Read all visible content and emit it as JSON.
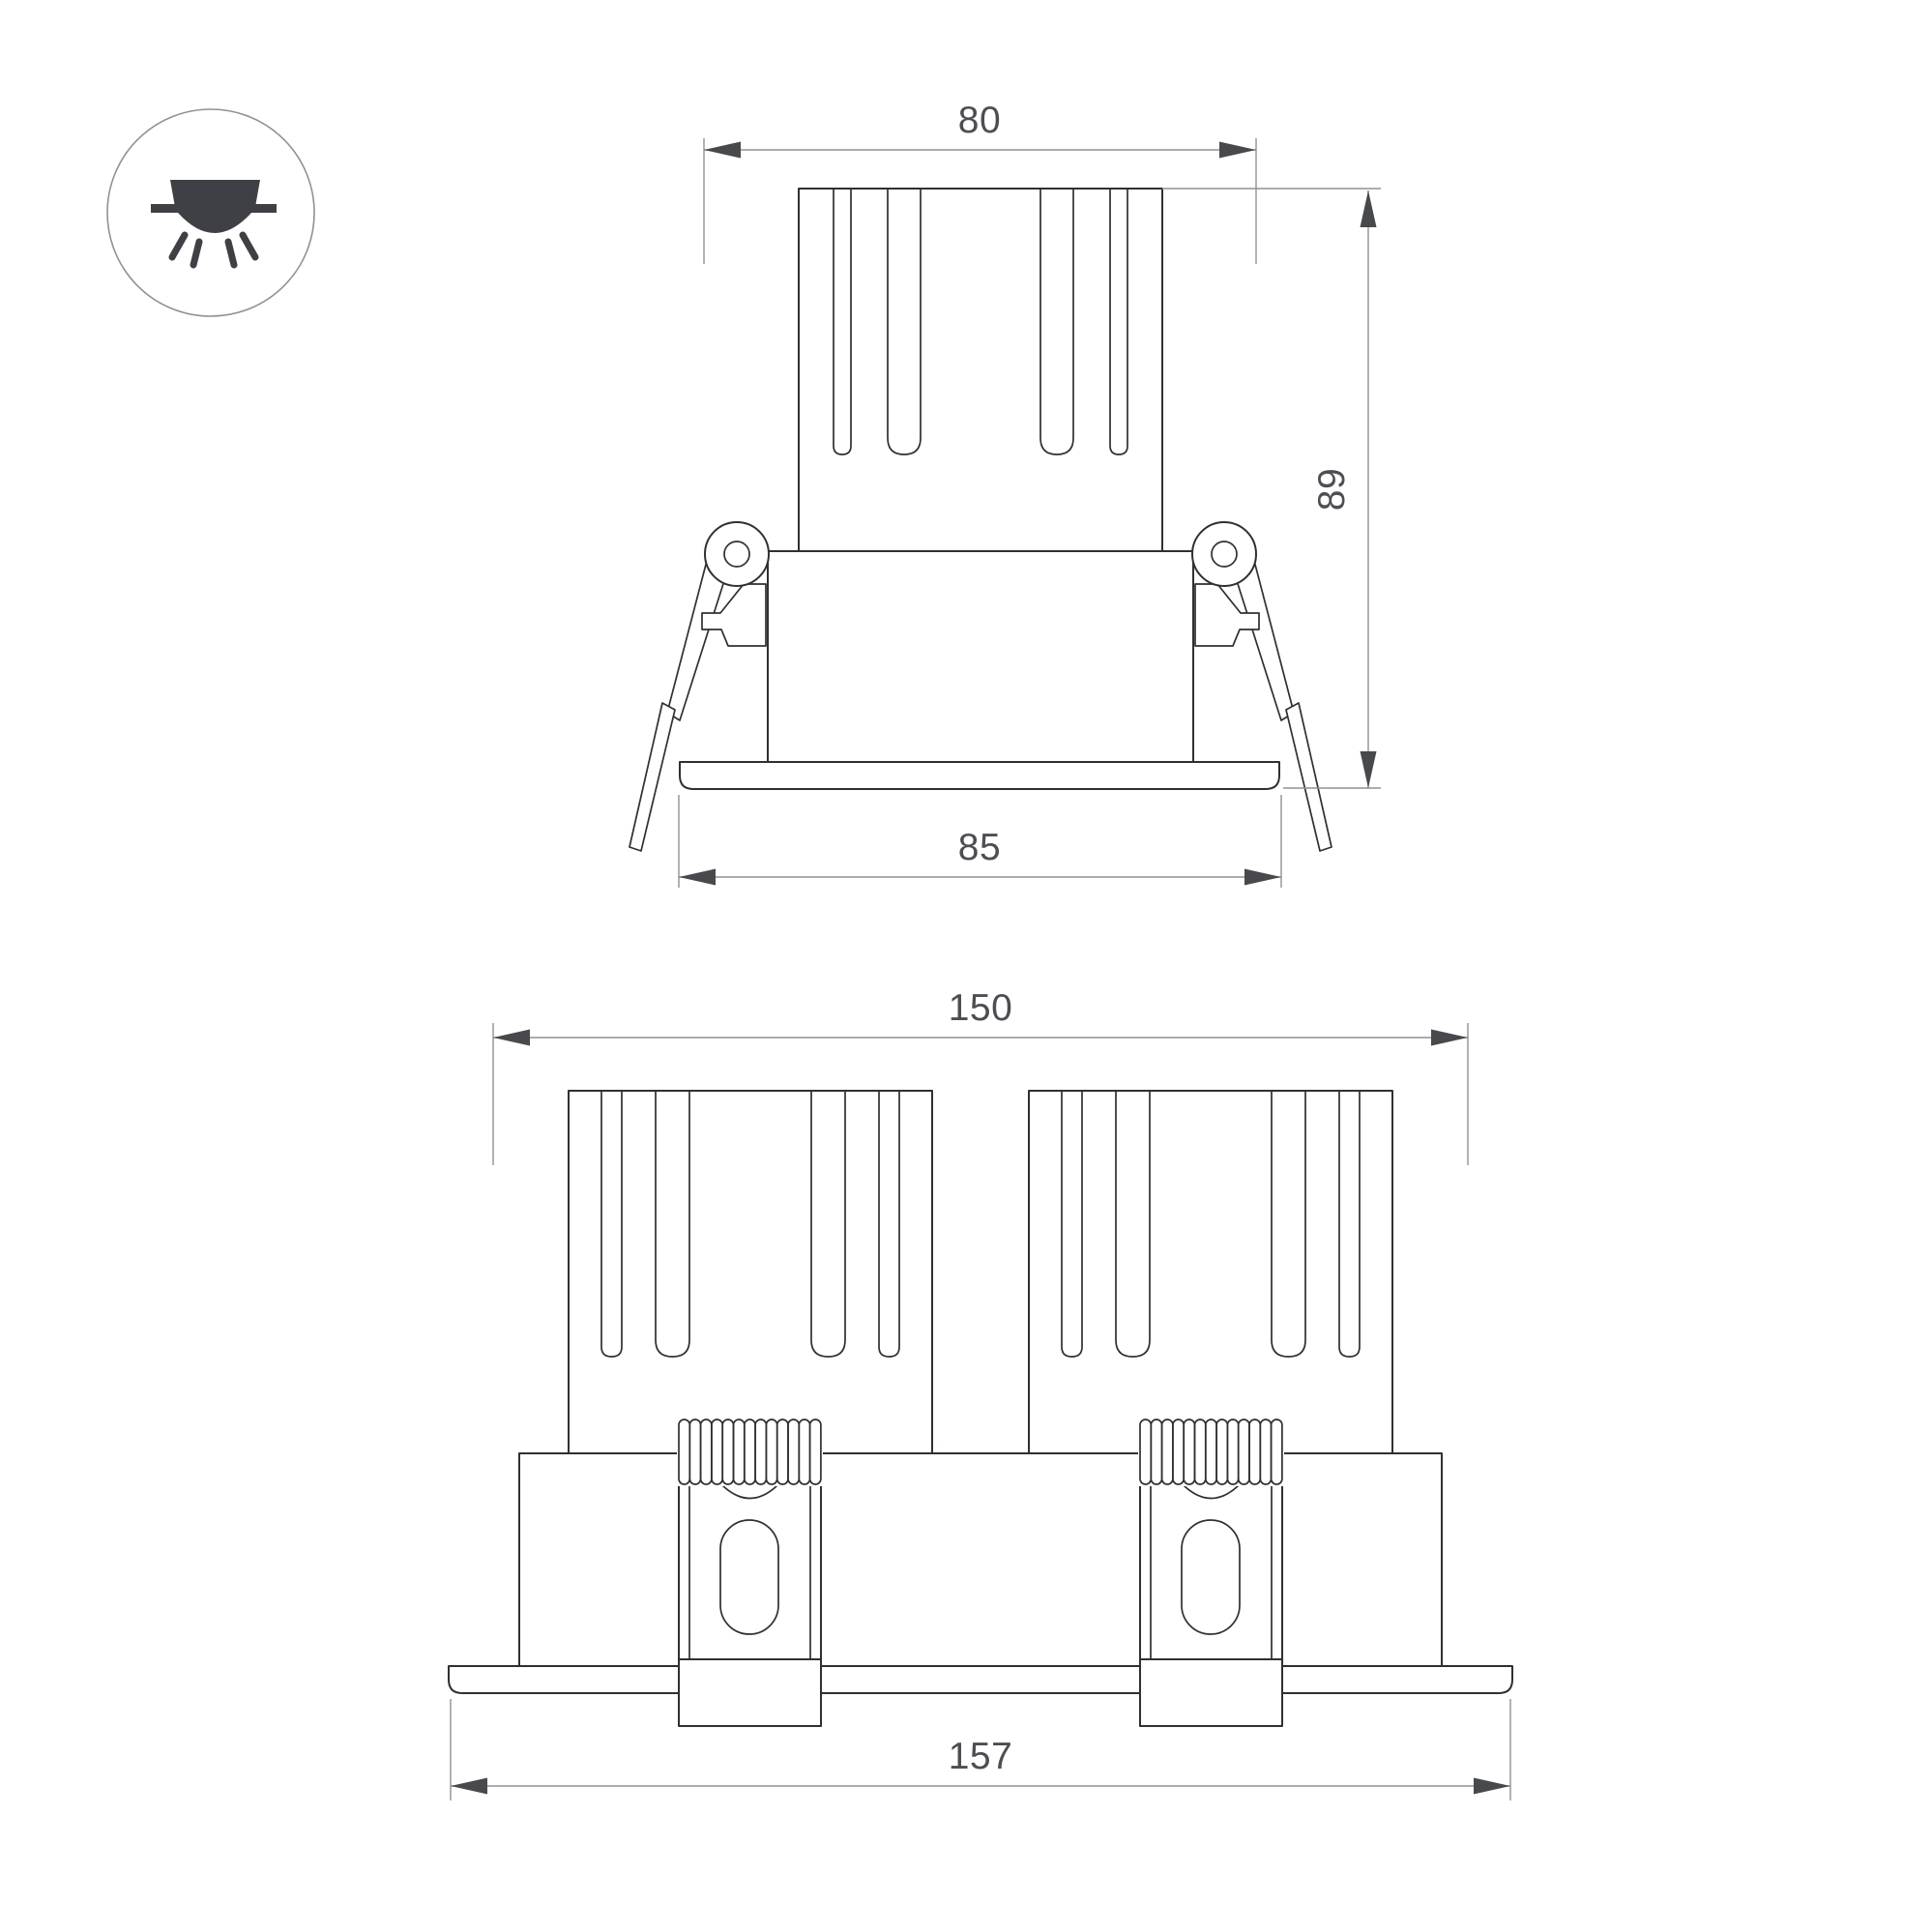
{
  "title": "recessed-downlight-dimension-drawing",
  "legend_icon": "recessed-downlight-symbol",
  "views": {
    "single": {
      "name": "front-view-single-module",
      "dim_top_width": "80",
      "dim_height": "89",
      "dim_flange_width": "85"
    },
    "double": {
      "name": "front-view-double-module",
      "dim_cutout_width": "150",
      "dim_flange_width": "157"
    }
  },
  "colors": {
    "background": "#ffffff",
    "outline": "#2e3034",
    "dimension": "#8f9195",
    "arrow": "#47494d",
    "text": "#4c4e53",
    "icon": "#3e4046"
  }
}
